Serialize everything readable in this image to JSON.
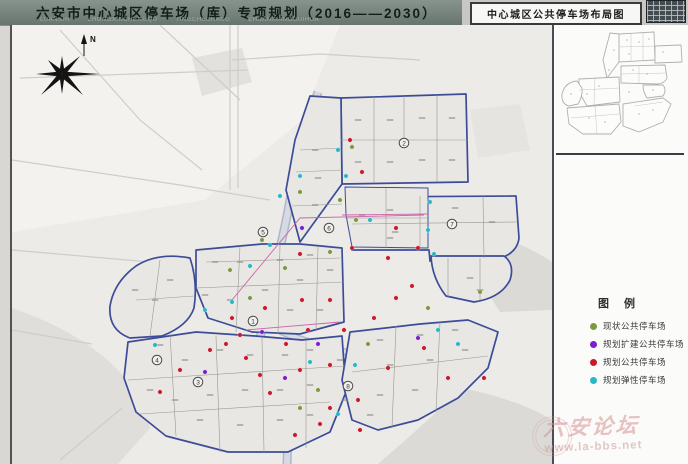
{
  "header": {
    "title": "六安市中心城区停车场（库）专项规划（2016——2030）",
    "subtitle_pinyin": "LUANSHI  ZHONGXINCHENGQU  TINGCHECHANG  ZHUANXIANGGUIHUA"
  },
  "map_title_box": {
    "label": "中心城区公共停车场布局图"
  },
  "compass": {
    "north_label": "N"
  },
  "legend": {
    "title": "图 例",
    "items": [
      {
        "key": "existing",
        "label": "现状公共停车场",
        "color": "#7a9a3d"
      },
      {
        "key": "expansion",
        "label": "规划扩建公共停车场",
        "color": "#7a1fd0"
      },
      {
        "key": "planned",
        "label": "规划公共停车场",
        "color": "#c81a2a"
      },
      {
        "key": "flexible",
        "label": "规划弹性停车场",
        "color": "#25b8c8"
      }
    ]
  },
  "watermark": {
    "site_name": "六安论坛",
    "url": "www.la-bbs.net"
  },
  "colors": {
    "boundary": "#3c4c98",
    "titlebar": "#79867f",
    "markers": {
      "existing": "#7a9a3d",
      "expansion": "#7a1fd0",
      "planned": "#c81a2a",
      "flexible": "#25b8c8"
    }
  },
  "zone_markers": [
    {
      "n": "1",
      "x": 253,
      "y": 321
    },
    {
      "n": "2",
      "x": 404,
      "y": 143
    },
    {
      "n": "3",
      "x": 198,
      "y": 382
    },
    {
      "n": "4",
      "x": 157,
      "y": 360
    },
    {
      "n": "5",
      "x": 263,
      "y": 232
    },
    {
      "n": "6",
      "x": 329,
      "y": 228
    },
    {
      "n": "7",
      "x": 452,
      "y": 224
    },
    {
      "n": "8",
      "x": 348,
      "y": 386
    }
  ],
  "map_markers": {
    "existing": [
      [
        352,
        147
      ],
      [
        300,
        192
      ],
      [
        340,
        200
      ],
      [
        285,
        268
      ],
      [
        250,
        298
      ],
      [
        318,
        390
      ],
      [
        368,
        344
      ],
      [
        428,
        308
      ],
      [
        300,
        408
      ],
      [
        356,
        220
      ],
      [
        230,
        270
      ],
      [
        262,
        240
      ],
      [
        480,
        292
      ],
      [
        330,
        252
      ]
    ],
    "expansion": [
      [
        262,
        332
      ],
      [
        318,
        344
      ],
      [
        285,
        378
      ],
      [
        418,
        338
      ],
      [
        205,
        372
      ],
      [
        302,
        228
      ]
    ],
    "planned": [
      [
        362,
        172
      ],
      [
        388,
        258
      ],
      [
        300,
        254
      ],
      [
        265,
        308
      ],
      [
        286,
        344
      ],
      [
        308,
        330
      ],
      [
        344,
        330
      ],
      [
        374,
        318
      ],
      [
        396,
        298
      ],
      [
        412,
        286
      ],
      [
        424,
        348
      ],
      [
        448,
        378
      ],
      [
        330,
        300
      ],
      [
        270,
        393
      ],
      [
        246,
        358
      ],
      [
        226,
        344
      ],
      [
        352,
        248
      ],
      [
        396,
        228
      ],
      [
        418,
        248
      ],
      [
        302,
        300
      ],
      [
        320,
        424
      ],
      [
        358,
        400
      ],
      [
        388,
        368
      ],
      [
        484,
        378
      ],
      [
        232,
        318
      ],
      [
        210,
        350
      ],
      [
        240,
        335
      ],
      [
        260,
        375
      ],
      [
        300,
        370
      ],
      [
        330,
        408
      ],
      [
        295,
        435
      ],
      [
        180,
        370
      ],
      [
        350,
        140
      ],
      [
        330,
        365
      ],
      [
        160,
        392
      ],
      [
        360,
        430
      ]
    ],
    "flexible": [
      [
        338,
        150
      ],
      [
        346,
        176
      ],
      [
        300,
        176
      ],
      [
        280,
        196
      ],
      [
        232,
        302
      ],
      [
        250,
        266
      ],
      [
        434,
        254
      ],
      [
        438,
        330
      ],
      [
        458,
        344
      ],
      [
        338,
        414
      ],
      [
        310,
        362
      ],
      [
        428,
        230
      ],
      [
        205,
        310
      ],
      [
        355,
        365
      ],
      [
        270,
        245
      ],
      [
        430,
        202
      ],
      [
        370,
        220
      ],
      [
        155,
        345
      ]
    ]
  }
}
